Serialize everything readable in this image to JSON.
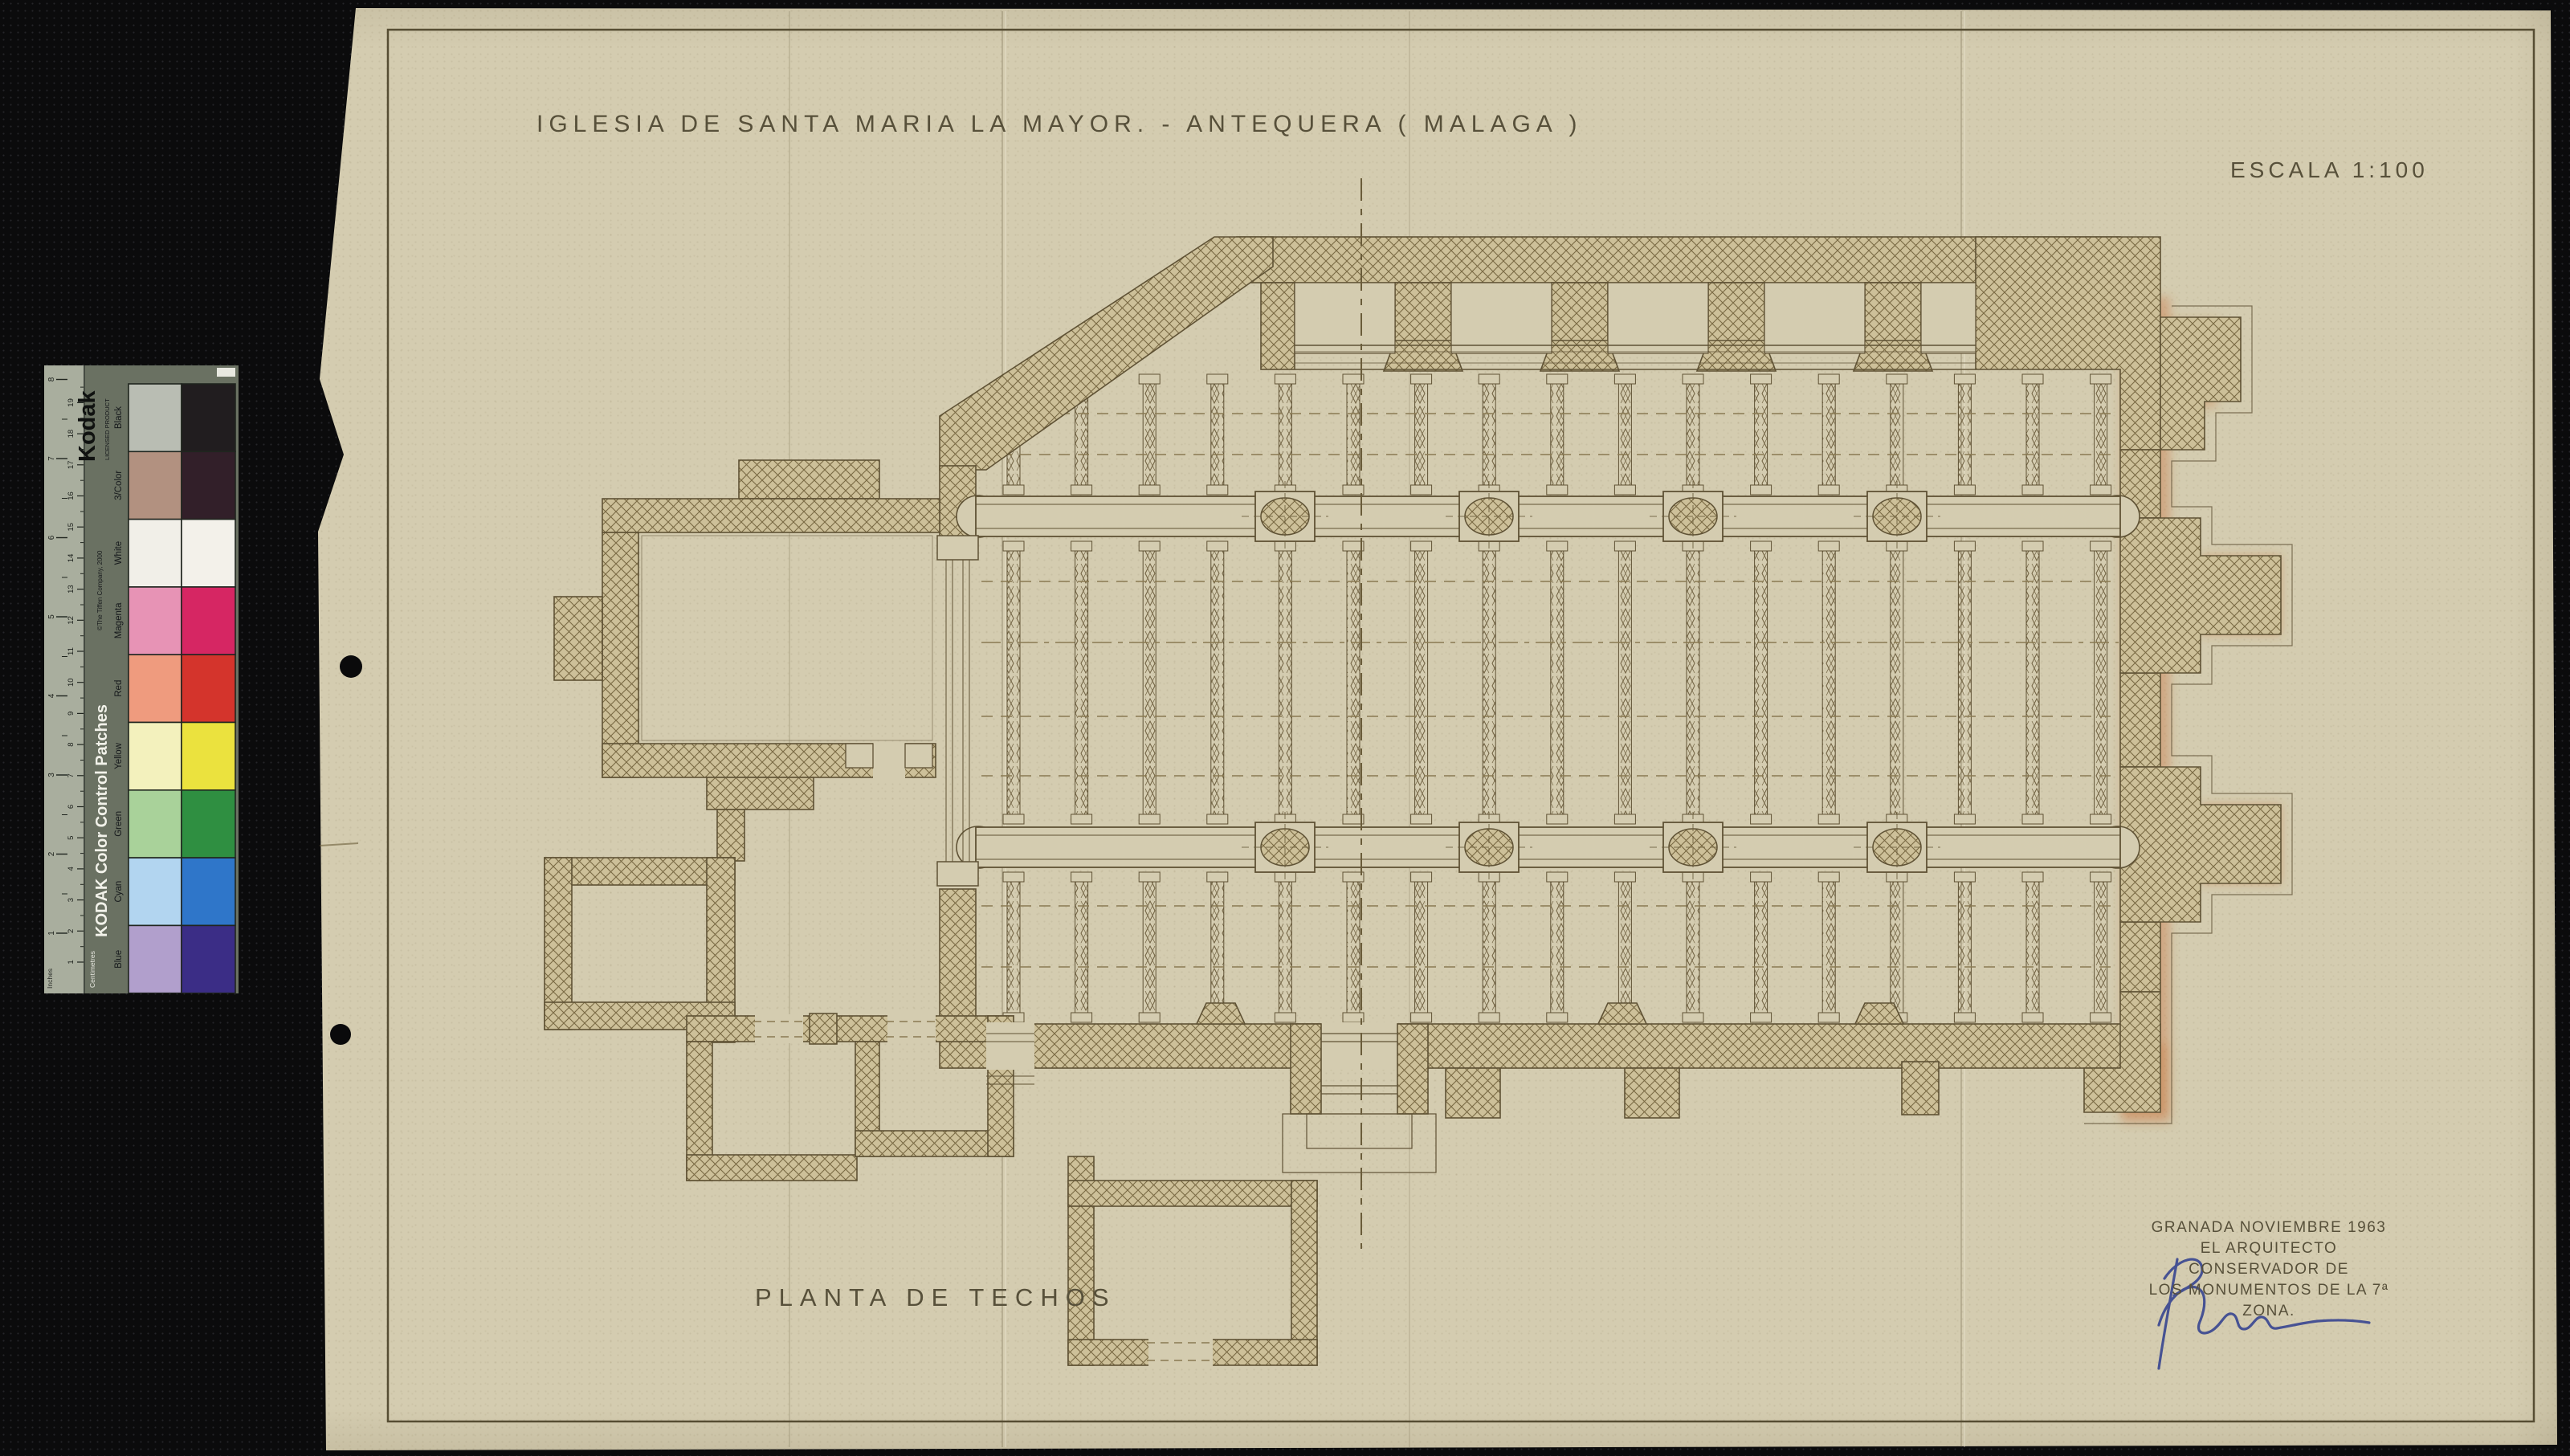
{
  "drawing": {
    "title": "IGLESIA DE SANTA MARIA LA MAYOR. - ANTEQUERA ( MALAGA )",
    "scale_label": "ESCALA 1:100",
    "plan_label": "PLANTA DE TECHOS",
    "credit_line1": "GRANADA NOVIEMBRE 1963",
    "credit_line2": "EL ARQUITECTO CONSERVADOR DE",
    "credit_line3": "LOS MONUMENTOS DE LA 7ª ZONA.",
    "signature_ink_color": "#33418f"
  },
  "kodak_strip": {
    "brand": "Kodak",
    "licensed": "LICENSED PRODUCT",
    "strip_title": "KODAK Color Control Patches",
    "copyright": "©The Tiffen Company, 2000",
    "cm_label": "Centimetres",
    "inch_label": "Inches",
    "cm_numbers": [
      1,
      2,
      3,
      4,
      5,
      6,
      7,
      8,
      9,
      10,
      11,
      12,
      13,
      14,
      15,
      16,
      17,
      18,
      19
    ],
    "inch_numbers": [
      1,
      2,
      3,
      4,
      5,
      6,
      7,
      8
    ],
    "patches": [
      {
        "label": "Black",
        "tint": "#b9bdb3",
        "solid": "#211d1f"
      },
      {
        "label": "3/Color",
        "tint": "#b29180",
        "solid": "#321f29"
      },
      {
        "label": "White",
        "tint": "#f1efe8",
        "solid": "#f3f1ea"
      },
      {
        "label": "Magenta",
        "tint": "#e793b5",
        "solid": "#d62663"
      },
      {
        "label": "Red",
        "tint": "#ef9b7e",
        "solid": "#d4342c"
      },
      {
        "label": "Yellow",
        "tint": "#f3f1bd",
        "solid": "#ebe23e"
      },
      {
        "label": "Green",
        "tint": "#a9d29a",
        "solid": "#2f8f41"
      },
      {
        "label": "Cyan",
        "tint": "#b2d5f0",
        "solid": "#2f76c9"
      },
      {
        "label": "Blue",
        "tint": "#b19fcc",
        "solid": "#3b2d86"
      }
    ]
  },
  "colors": {
    "paper": "#d4ccb0",
    "ink": "#5f5235",
    "orange_wash": "#c8743c",
    "background": "#0b0b0c",
    "strip_body": "#6a7162"
  }
}
